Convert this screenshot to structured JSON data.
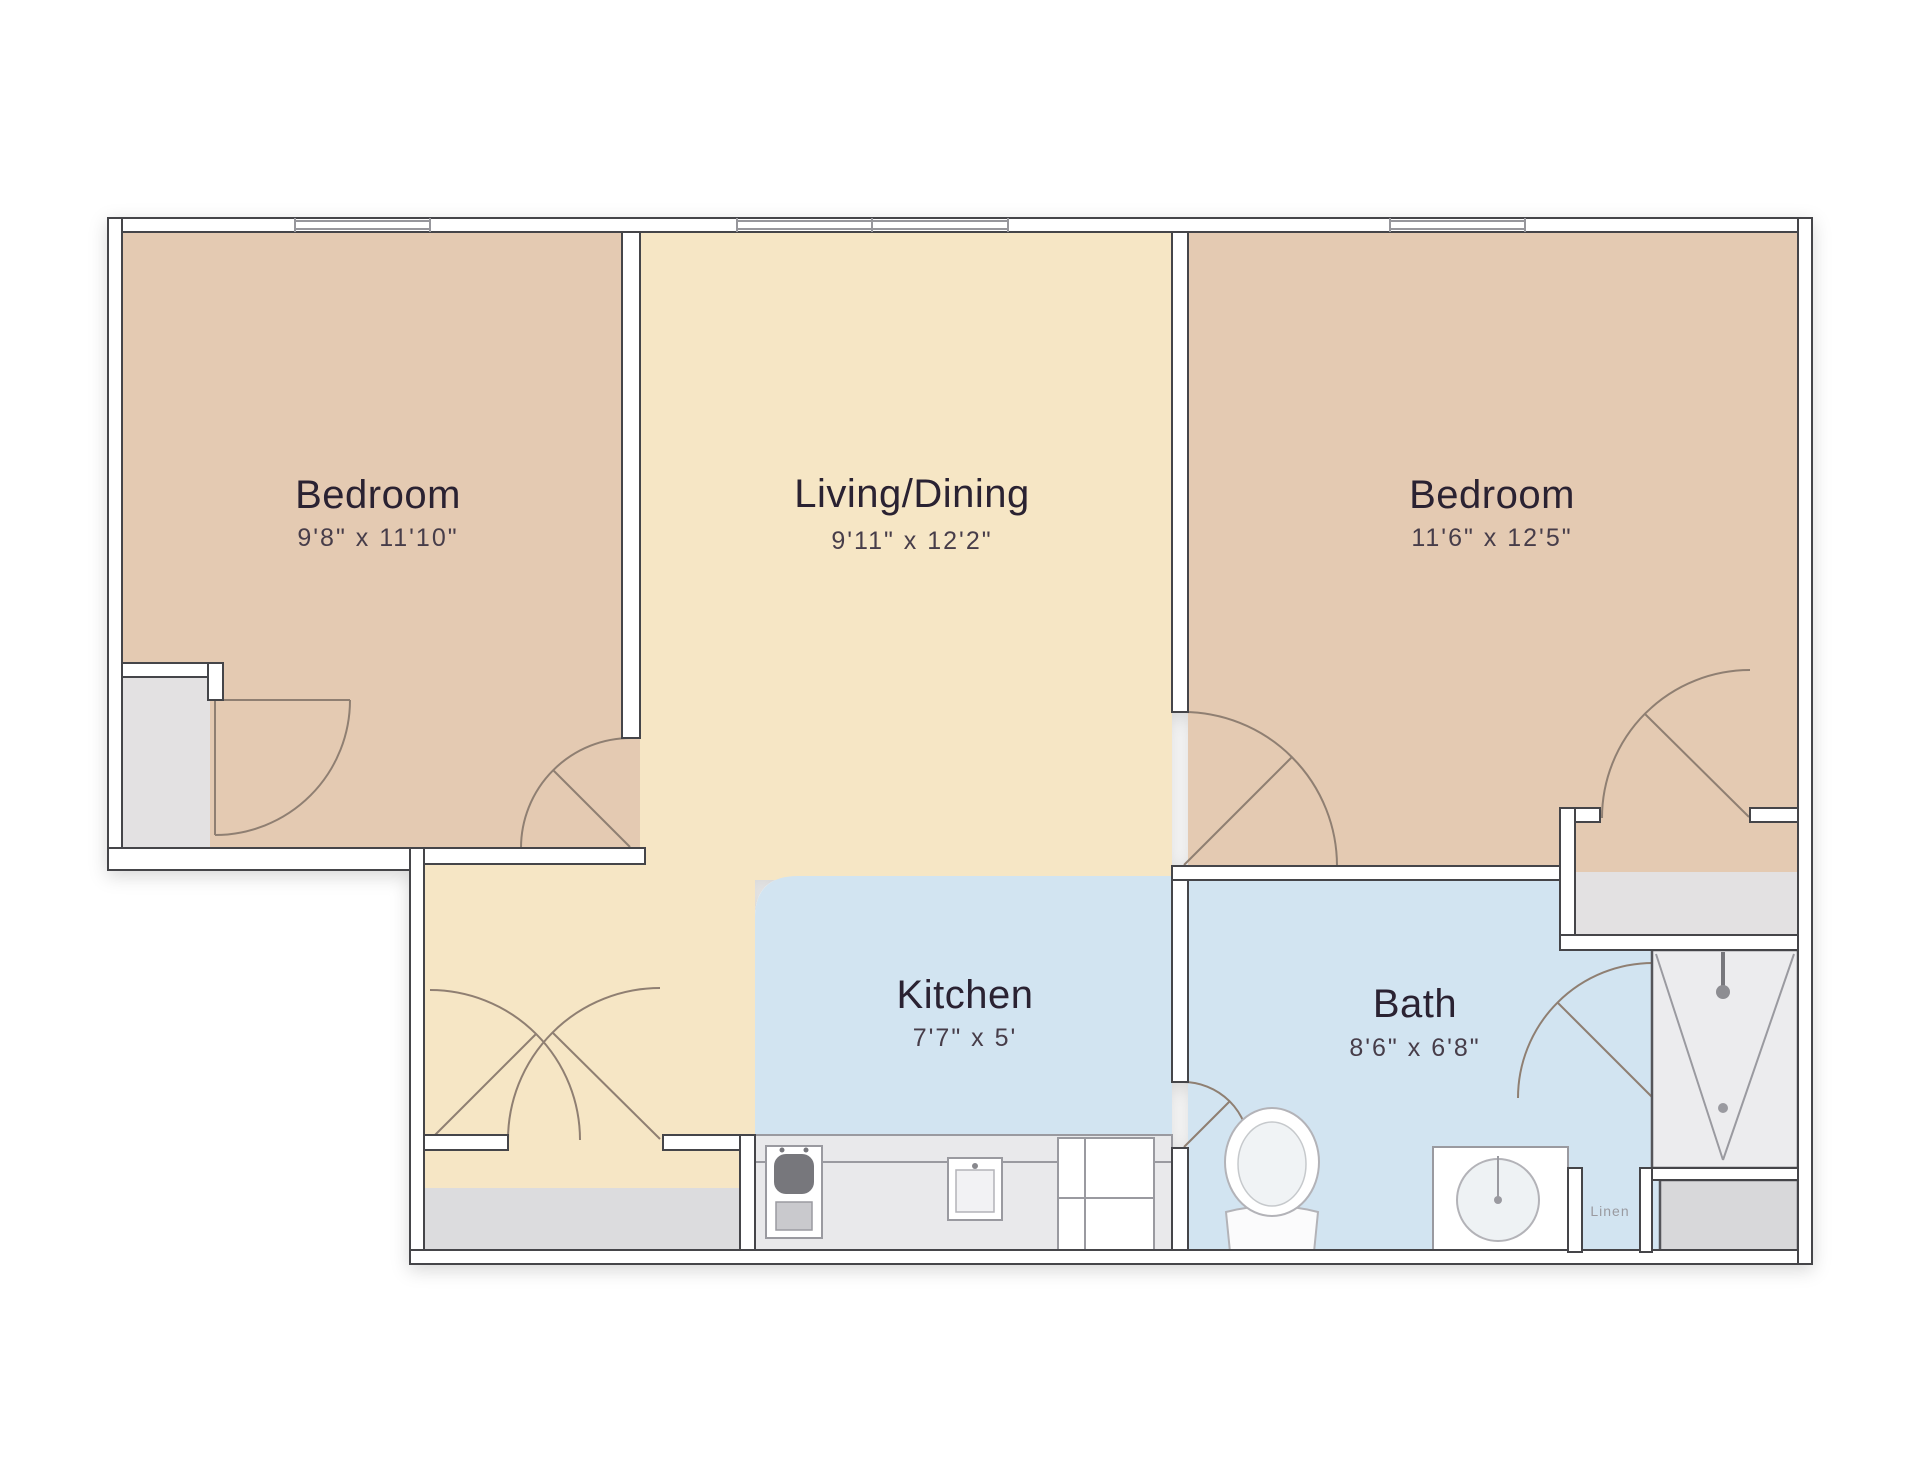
{
  "floorplan": {
    "rooms": [
      {
        "name": "Bedroom",
        "dims": "9'8\" x 11'10\""
      },
      {
        "name": "Living/Dining",
        "dims": "9'11\" x 12'2\""
      },
      {
        "name": "Bedroom",
        "dims": "11'6\" x 12'5\""
      },
      {
        "name": "Kitchen",
        "dims": "7'7\" x 5'"
      },
      {
        "name": "Bath",
        "dims": "8'6\" x 6'8\""
      }
    ],
    "closet_label": "Linen",
    "colors": {
      "bedroom_fill": "#e4cab2",
      "living_fill": "#f6e6c5",
      "wet_room_fill": "#d2e4f1",
      "closet_fill": "#e3e1e2",
      "counter_fill": "#e9e9eb",
      "shower_fill": "#ececee",
      "entry_mat_fill": "#dcdcde",
      "wall_stroke": "#45454a",
      "door_stroke": "#8f7f72"
    }
  }
}
